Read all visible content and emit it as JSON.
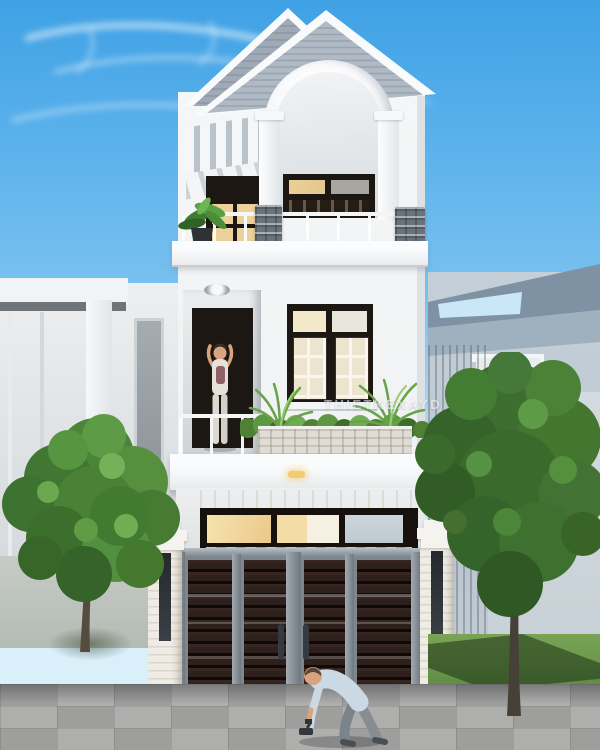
{
  "watermark": {
    "text": "THIETKEXAYD"
  },
  "palette": {
    "sky_top": "#3FA1E5",
    "sky_mid": "#7FC3F0",
    "sky_horizon": "#D9EFFA",
    "house_white": "#F5F6F7",
    "house_shade": "#DDE1E4",
    "roof_siding": "#AFB9C4",
    "trim_white": "#FAFBFC",
    "frame_dark": "#1D1713",
    "glass_warm": "#F2DCA6",
    "glass_cool": "#C8D2D9",
    "gate_wood": "#2E201D",
    "gate_frame": "#8C959D",
    "planter_stone": "#E0DCD4",
    "beige_wall": "#EADFC9",
    "pillar_white": "#EFECE5",
    "pillar_base": "#3F454C",
    "tree_green": "#4C8539",
    "tree_green_dark": "#3B672E",
    "grass": "#6E9B4F",
    "pavement": "#A6A7A5",
    "neighbor_left": "#E6E9EA",
    "neighbor_right": "#C5CFD7",
    "neighbor_right_roof": "#7E92A4",
    "watermark_color": "rgba(255,255,255,0.55)"
  }
}
